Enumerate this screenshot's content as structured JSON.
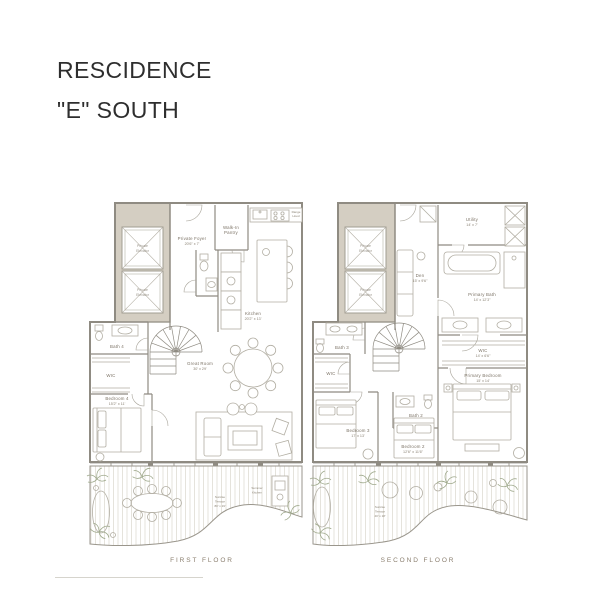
{
  "title": {
    "line1": "RESCIDENCE",
    "line2": "\"E\" SOUTH"
  },
  "colors": {
    "background": "#ffffff",
    "title_text": "#2e2e2e",
    "wall": "#8f8b82",
    "core_fill": "#d4cec2",
    "furniture": "#b2aea3",
    "room_label": "#7c7366",
    "floor_label": "#8a7e6e",
    "plant": "#9fa98c"
  },
  "first_floor": {
    "label": "FIRST FLOOR",
    "rooms": {
      "private_elevator": [
        "Private",
        "Elevator"
      ],
      "private_foyer": {
        "name": "Private Foyer",
        "dims": "20'6\" x 7'"
      },
      "walk_in_pantry": [
        "Walk-In",
        "Pantry"
      ],
      "range_hood": [
        "Range",
        "Hood"
      ],
      "kitchen": {
        "name": "Kitchen",
        "dims": "20'2\" x 13'"
      },
      "great_room": {
        "name": "Great Room",
        "dims": "30' x 29'"
      },
      "bath_4": "Bath 4",
      "wic": "WIC",
      "bedroom_4": {
        "name": "Bedroom 4",
        "dims": "15'2\" x 11'"
      },
      "sunrise_terrace": {
        "name": [
          "Sunrise",
          "Terrace"
        ],
        "dims": "80' x 19'"
      },
      "summer_kitchen": [
        "Summer",
        "Kitchen"
      ]
    }
  },
  "second_floor": {
    "label": "SECOND FLOOR",
    "rooms": {
      "private_elevator": [
        "Private",
        "Elevator"
      ],
      "den": {
        "name": "Den",
        "dims": "15' x 9'6\""
      },
      "utility": {
        "name": "Utility",
        "dims": "14' x 7'"
      },
      "primary_bath": {
        "name": "Primary Bath",
        "dims": "14' x 12'3\""
      },
      "primary_wic": {
        "name": "WIC",
        "dims": "14' x 6'6\""
      },
      "primary_bedroom": {
        "name": "Primary Bedroom",
        "dims": "15' x 14'"
      },
      "bath_3": "Bath 3",
      "wic": "WIC",
      "bedroom_3": {
        "name": "Bedroom 3",
        "dims": "17' x 13'"
      },
      "bath_2": "Bath 2",
      "bedroom_2": {
        "name": "Bedroom 2",
        "dims": "12'6\" x 11'6\""
      },
      "sunrise_terrace": {
        "name": [
          "Sunrise",
          "Terrace"
        ],
        "dims": "40' x 18'"
      }
    }
  }
}
